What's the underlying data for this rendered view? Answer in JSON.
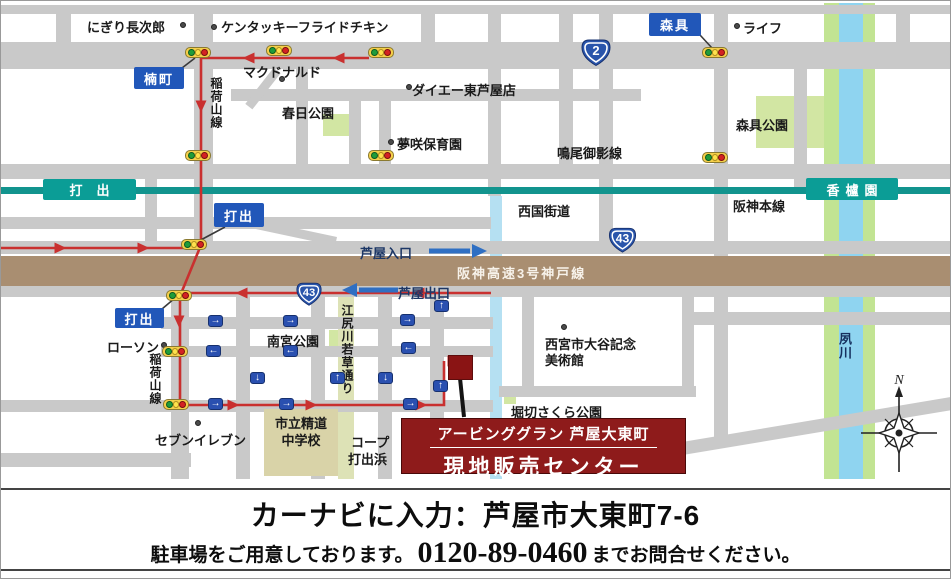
{
  "meta": {
    "width": 949,
    "height": 577
  },
  "colors": {
    "road": "#c9c9c9",
    "rail": "#12948e",
    "station": "#0b9d96",
    "expressway": "#a98e71",
    "river_blue": "#8fd4f0",
    "river_bank": "#c2e493",
    "canal": "#b5e0f2",
    "khaki": "#dde2b6",
    "park": "#d2e6a3",
    "school": "#d9d3a8",
    "blue_box": "#2157b9",
    "shield": "#2a55ab",
    "oneway": "#2a50b0",
    "route_red": "#c9302f",
    "dest_red": "#8e1b1b",
    "navy": "#1d3766"
  },
  "map": {
    "roads_h": [
      [
        0,
        4,
        949,
        9
      ],
      [
        0,
        41,
        949,
        27
      ],
      [
        230,
        88,
        410,
        12
      ],
      [
        0,
        163,
        949,
        15
      ],
      [
        0,
        216,
        490,
        12
      ],
      [
        0,
        240,
        949,
        13
      ],
      [
        0,
        285,
        949,
        11
      ],
      [
        160,
        316,
        332,
        12
      ],
      [
        693,
        311,
        256,
        13
      ],
      [
        160,
        345,
        332,
        11
      ],
      [
        0,
        399,
        492,
        12
      ],
      [
        0,
        452,
        190,
        14
      ],
      [
        498,
        385,
        197,
        11
      ]
    ],
    "roads_v": [
      [
        55,
        4,
        15,
        38
      ],
      [
        193,
        12,
        19,
        235
      ],
      [
        144,
        165,
        12,
        76
      ],
      [
        295,
        63,
        12,
        101
      ],
      [
        348,
        100,
        12,
        64
      ],
      [
        378,
        100,
        12,
        64
      ],
      [
        420,
        4,
        14,
        64
      ],
      [
        487,
        12,
        13,
        183
      ],
      [
        558,
        4,
        14,
        160
      ],
      [
        598,
        12,
        14,
        241
      ],
      [
        713,
        4,
        14,
        292
      ],
      [
        793,
        41,
        13,
        148
      ],
      [
        895,
        4,
        14,
        38
      ],
      [
        170,
        293,
        18,
        185
      ],
      [
        235,
        296,
        14,
        182
      ],
      [
        310,
        296,
        14,
        182
      ],
      [
        377,
        296,
        14,
        182
      ],
      [
        429,
        296,
        14,
        130
      ],
      [
        521,
        296,
        12,
        95
      ],
      [
        681,
        296,
        12,
        100
      ],
      [
        713,
        296,
        14,
        142
      ]
    ],
    "diagonals": [
      {
        "cx": 262,
        "cy": 87,
        "len": 46,
        "w": 9,
        "ang": -52
      },
      {
        "cx": 293,
        "cy": 231,
        "len": 86,
        "w": 9,
        "ang": 12
      },
      {
        "cx": 813,
        "cy": 425,
        "len": 282,
        "w": 13,
        "ang": -9.5
      }
    ],
    "river": {
      "name": "夙川",
      "y": 2,
      "h": 476,
      "bands": [
        {
          "x": 823,
          "w": 15,
          "kind": "bank"
        },
        {
          "x": 838,
          "w": 24,
          "kind": "water"
        },
        {
          "x": 862,
          "w": 12,
          "kind": "bank"
        }
      ]
    },
    "canal": {
      "x": 489,
      "y": 195,
      "w": 12,
      "h": 283
    },
    "greenway": {
      "x": 337,
      "y": 295,
      "w": 16,
      "h": 183
    },
    "parks": [
      {
        "x": 322,
        "y": 113,
        "w": 26,
        "h": 22
      },
      {
        "x": 755,
        "y": 95,
        "w": 68,
        "h": 52
      },
      {
        "x": 328,
        "y": 329,
        "w": 19,
        "h": 19
      },
      {
        "x": 503,
        "y": 385,
        "w": 12,
        "h": 18
      }
    ],
    "school": {
      "x": 263,
      "y": 408,
      "w": 74,
      "h": 67,
      "line1": "市立精道",
      "line2": "中学校"
    },
    "railway": {
      "line_label": "阪神本線",
      "stations": [
        {
          "label": "打出",
          "x": 42,
          "y": 178,
          "w": 93,
          "h": 21,
          "spacing": "14px"
        },
        {
          "label": "香櫨園",
          "x": 805,
          "y": 177,
          "w": 92,
          "h": 22,
          "spacing": "6px"
        }
      ]
    },
    "expressway": {
      "label": "阪神高速3号神戸線"
    },
    "labels": [
      {
        "t": "にぎり長次郎",
        "x": 86,
        "y": 16
      },
      {
        "t": "ケンタッキーフライドチキン",
        "x": 220,
        "y": 16
      },
      {
        "t": "マクドナルド",
        "x": 242,
        "y": 61
      },
      {
        "t": "ダイエー東芦屋店",
        "x": 411,
        "y": 79
      },
      {
        "t": "夢咲保育園",
        "x": 396,
        "y": 133
      },
      {
        "t": "春日公園",
        "x": 281,
        "y": 102
      },
      {
        "t": "鳴尾御影線",
        "x": 556,
        "y": 142
      },
      {
        "t": "ライフ",
        "x": 742,
        "y": 17
      },
      {
        "t": "森具公園",
        "x": 735,
        "y": 114
      },
      {
        "t": "西国街道",
        "x": 517,
        "y": 200
      },
      {
        "t": "阪神本線",
        "x": 732,
        "y": 195
      },
      {
        "t": "芦屋入口",
        "x": 359,
        "y": 242,
        "navy": true
      },
      {
        "t": "芦屋出口",
        "x": 397,
        "y": 282,
        "navy": true
      },
      {
        "t": "ローソン",
        "x": 106,
        "y": 336
      },
      {
        "t": "南宮公園",
        "x": 266,
        "y": 330
      },
      {
        "t": "セブンイレブン",
        "x": 154,
        "y": 429
      },
      {
        "t": "コープ",
        "x": 350,
        "y": 431
      },
      {
        "t": "打出浜",
        "x": 347,
        "y": 448
      },
      {
        "t": "堀切さくら公園",
        "x": 510,
        "y": 401
      },
      {
        "t": "西宮市大谷記念",
        "x": 544,
        "y": 333
      },
      {
        "t": "美術館",
        "x": 544,
        "y": 349
      }
    ],
    "vlabels": [
      {
        "t": "稲荷山線",
        "x": 207,
        "y": 76,
        "h": 84
      },
      {
        "t": "稲荷山線",
        "x": 146,
        "y": 352,
        "h": 84
      },
      {
        "t": "江尻川若草通り",
        "x": 338,
        "y": 303,
        "h": 122
      },
      {
        "t": "夙川",
        "x": 835,
        "y": 331,
        "h": 40,
        "navy": true
      }
    ],
    "blue_boxes": [
      {
        "label": "楠町",
        "x": 133,
        "y": 66,
        "w": 50,
        "h": 22,
        "leader": [
          181,
          67,
          194,
          57
        ]
      },
      {
        "label": "森具",
        "x": 648,
        "y": 12,
        "w": 52,
        "h": 23,
        "leader": [
          699,
          34,
          711,
          47
        ]
      },
      {
        "label": "打出",
        "x": 213,
        "y": 202,
        "w": 50,
        "h": 24,
        "leader": [
          224,
          226,
          196,
          241
        ]
      },
      {
        "label": "打出",
        "x": 114,
        "y": 307,
        "w": 49,
        "h": 20,
        "leader": [
          161,
          308,
          174,
          297
        ]
      }
    ],
    "shields": [
      {
        "num": "2",
        "x": 578,
        "y": 36,
        "w": 34,
        "h": 31
      },
      {
        "num": "43",
        "x": 605,
        "y": 225,
        "w": 33,
        "h": 28
      },
      {
        "num": "43",
        "x": 293,
        "y": 280,
        "w": 30,
        "h": 26
      }
    ],
    "lights": [
      [
        197,
        52
      ],
      [
        278,
        50
      ],
      [
        380,
        52
      ],
      [
        714,
        52
      ],
      [
        197,
        155
      ],
      [
        380,
        155
      ],
      [
        714,
        157
      ],
      [
        193,
        244
      ],
      [
        178,
        295
      ],
      [
        174,
        351
      ],
      [
        175,
        404
      ]
    ],
    "oneways": [
      [
        215,
        320,
        "R"
      ],
      [
        290,
        320,
        "R"
      ],
      [
        407,
        319,
        "R"
      ],
      [
        441,
        305,
        "U"
      ],
      [
        213,
        350,
        "L"
      ],
      [
        290,
        350,
        "L"
      ],
      [
        408,
        347,
        "L"
      ],
      [
        257,
        377,
        "D"
      ],
      [
        337,
        377,
        "U"
      ],
      [
        385,
        377,
        "D"
      ],
      [
        440,
        385,
        "U"
      ],
      [
        215,
        403,
        "R"
      ],
      [
        286,
        403,
        "R"
      ],
      [
        410,
        403,
        "R"
      ]
    ],
    "dots": [
      [
        182,
        24
      ],
      [
        213,
        26
      ],
      [
        281,
        78
      ],
      [
        408,
        86
      ],
      [
        390,
        141
      ],
      [
        736,
        25
      ],
      [
        163,
        344
      ],
      [
        197,
        422
      ],
      [
        563,
        326
      ]
    ],
    "route": {
      "paths": [
        [
          [
            368,
            57
          ],
          [
            200,
            57
          ],
          [
            200,
            244
          ],
          [
            179,
            295
          ],
          [
            179,
            404
          ],
          [
            443,
            404
          ],
          [
            443,
            360
          ]
        ],
        [
          [
            0,
            247
          ],
          [
            192,
            247
          ]
        ],
        [
          [
            490,
            292
          ],
          [
            180,
            292
          ]
        ]
      ],
      "arrowheads": [
        {
          "x": 340,
          "y": 57,
          "d": "L"
        },
        {
          "x": 250,
          "y": 57,
          "d": "L"
        },
        {
          "x": 200,
          "y": 103,
          "d": "D"
        },
        {
          "x": 178,
          "y": 318,
          "d": "D"
        },
        {
          "x": 57,
          "y": 247,
          "d": "R"
        },
        {
          "x": 140,
          "y": 247,
          "d": "R"
        },
        {
          "x": 243,
          "y": 292,
          "d": "L"
        },
        {
          "x": 420,
          "y": 292,
          "d": "L"
        },
        {
          "x": 230,
          "y": 404,
          "d": "R"
        },
        {
          "x": 308,
          "y": 404,
          "d": "R"
        },
        {
          "x": 418,
          "y": 404,
          "d": "R"
        },
        {
          "x": 450,
          "y": 360,
          "d": "R"
        }
      ]
    },
    "ramps": [
      {
        "x1": 428,
        "y1": 250,
        "x2": 469,
        "y2": 250,
        "d": "R"
      },
      {
        "x1": 397,
        "y1": 289,
        "x2": 358,
        "y2": 289,
        "d": "L"
      }
    ],
    "dest_leader": [
      459,
      377,
      463,
      416
    ],
    "destination": {
      "line1": "アービンググラン 芦屋大東町",
      "line2": "現地販売センター"
    },
    "compass": {
      "label": "N"
    }
  },
  "footer": {
    "line1": "カーナビに入力：芦屋市大東町7-6",
    "line2_pre": "駐車場をご用意しております。",
    "phone": "0120-89-0460",
    "line2_post": "までお問合せください。"
  }
}
